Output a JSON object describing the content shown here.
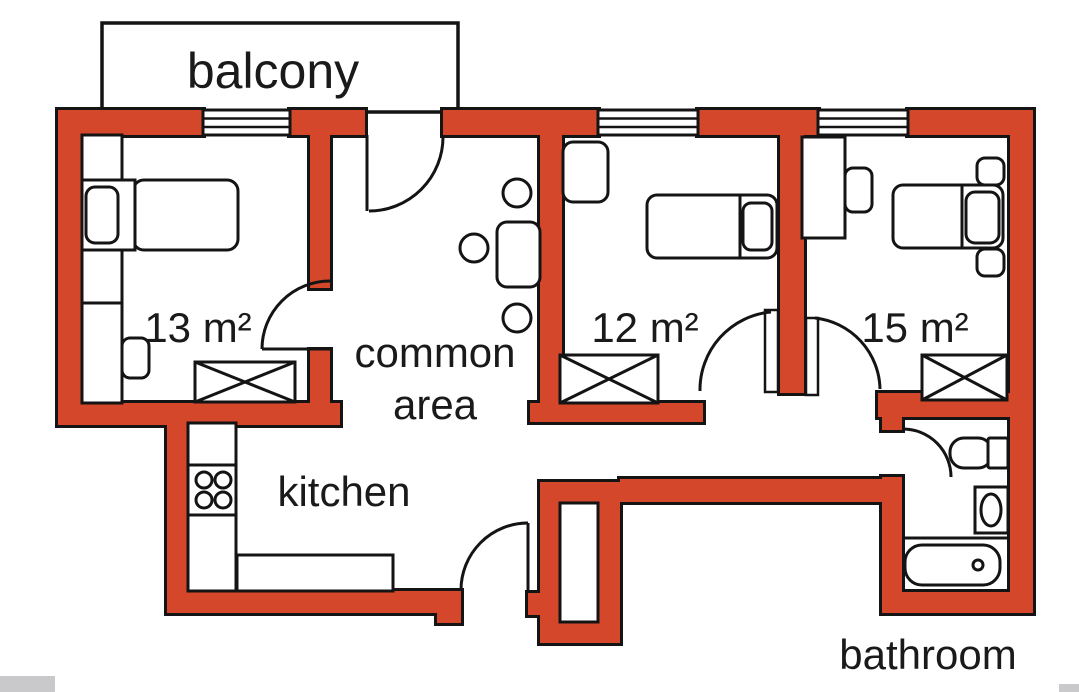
{
  "image_type": "apartment floor plan",
  "colors": {
    "wall_fill": "#d5472b",
    "wall_outline": "#141414",
    "background": "#ffffff",
    "label_text": "#1a1a1a",
    "page_strip": "#c9c9cc"
  },
  "labels": {
    "balcony": "balcony",
    "room13": "13 m²",
    "room12": "12 m²",
    "room15": "15 m²",
    "common_line1": "common",
    "common_line2": "area",
    "kitchen": "kitchen",
    "bathroom": "bathroom"
  },
  "rooms": [
    {
      "name": "balcony",
      "label": "balcony"
    },
    {
      "name": "bedroom-left",
      "label": "13 m²",
      "area_sqm": 13
    },
    {
      "name": "bedroom-middle",
      "label": "12 m²",
      "area_sqm": 12
    },
    {
      "name": "bedroom-right",
      "label": "15 m²",
      "area_sqm": 15
    },
    {
      "name": "common-area",
      "label": "common area"
    },
    {
      "name": "kitchen",
      "label": "kitchen"
    },
    {
      "name": "bathroom",
      "label": "bathroom"
    }
  ],
  "fixtures": [
    "bed",
    "pillow",
    "wardrobe",
    "desk",
    "chair",
    "table",
    "stove",
    "kitchen-counter",
    "toilet",
    "sink",
    "bathtub",
    "window",
    "door",
    "entrance-recess"
  ]
}
